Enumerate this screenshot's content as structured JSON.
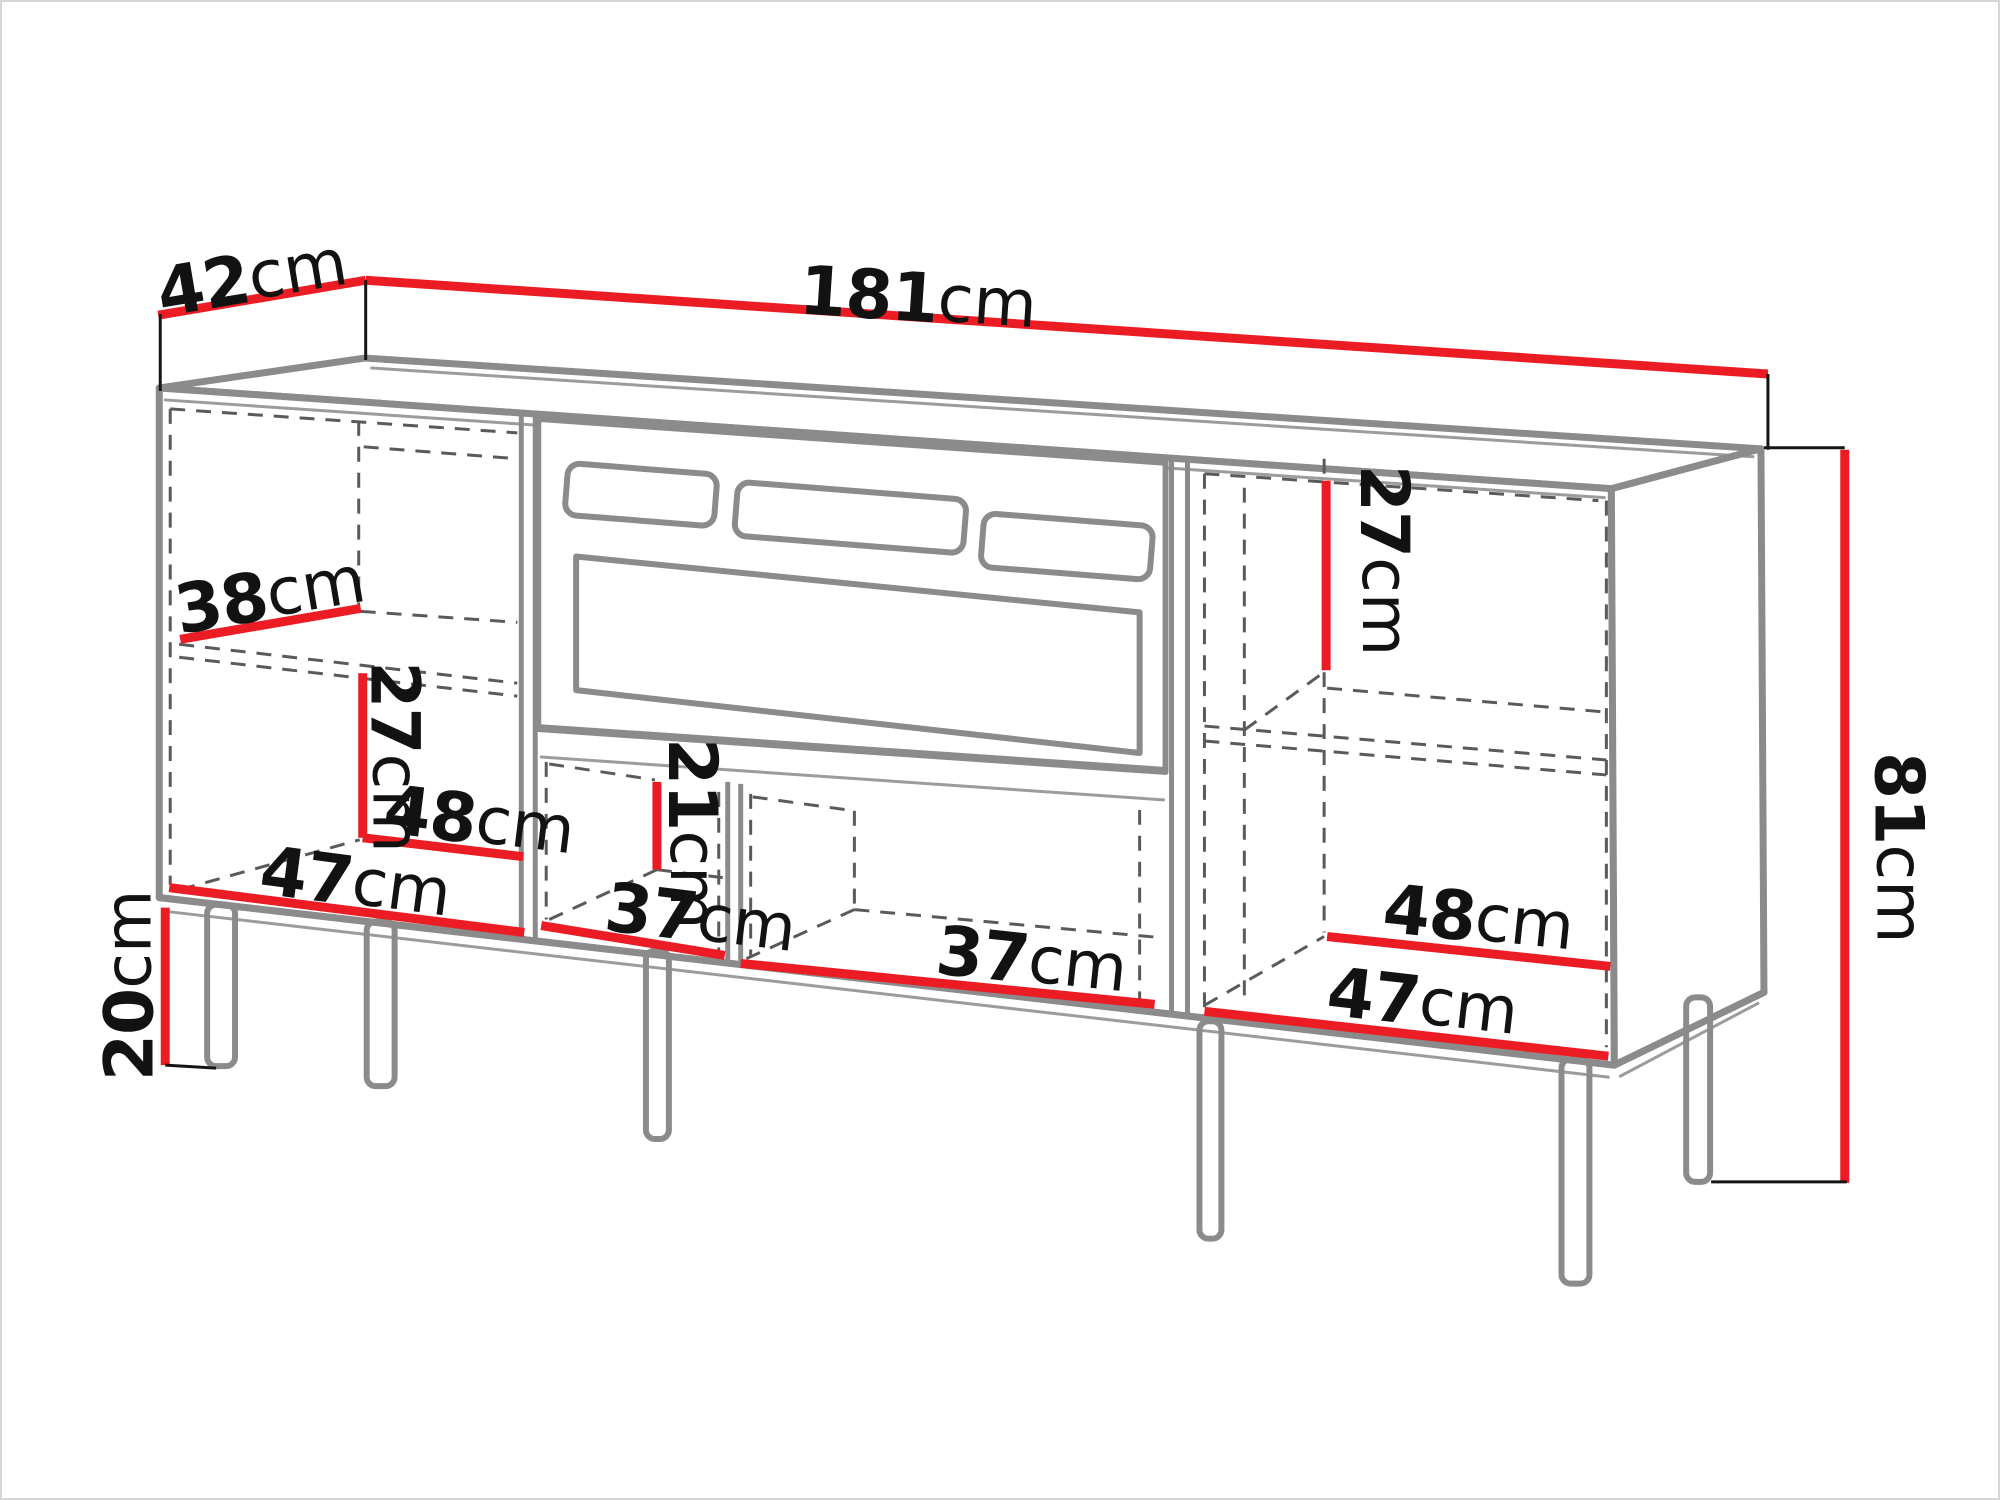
{
  "diagram": {
    "type": "furniture-dimension-drawing",
    "subject": "TV stand with fireplace insert, three sections and six legs",
    "unit": "cm",
    "labels": {
      "depth": {
        "value": "42",
        "unit": "cm"
      },
      "width": {
        "value": "181",
        "unit": "cm"
      },
      "height": {
        "value": "81",
        "unit": "cm"
      },
      "leg_height": {
        "value": "20",
        "unit": "cm"
      },
      "left_shelf_depth": {
        "value": "38",
        "unit": "cm"
      },
      "left_lower_height": {
        "value": "27",
        "unit": "cm"
      },
      "left_inner_width_back": {
        "value": "48",
        "unit": "cm"
      },
      "left_inner_width_front": {
        "value": "47",
        "unit": "cm"
      },
      "middle_niche_height": {
        "value": "21",
        "unit": "cm"
      },
      "middle_left_niche_width": {
        "value": "37",
        "unit": "cm"
      },
      "middle_right_niche_width": {
        "value": "37",
        "unit": "cm"
      },
      "right_upper_height": {
        "value": "27",
        "unit": "cm"
      },
      "right_inner_width_back": {
        "value": "48",
        "unit": "cm"
      },
      "right_inner_width_front": {
        "value": "47",
        "unit": "cm"
      }
    },
    "colors": {
      "dimension": "#ec1c24",
      "outline": "#8b8b8b",
      "dashed": "#5a5a5a",
      "label": "#121212",
      "background": "#ffffff"
    }
  }
}
